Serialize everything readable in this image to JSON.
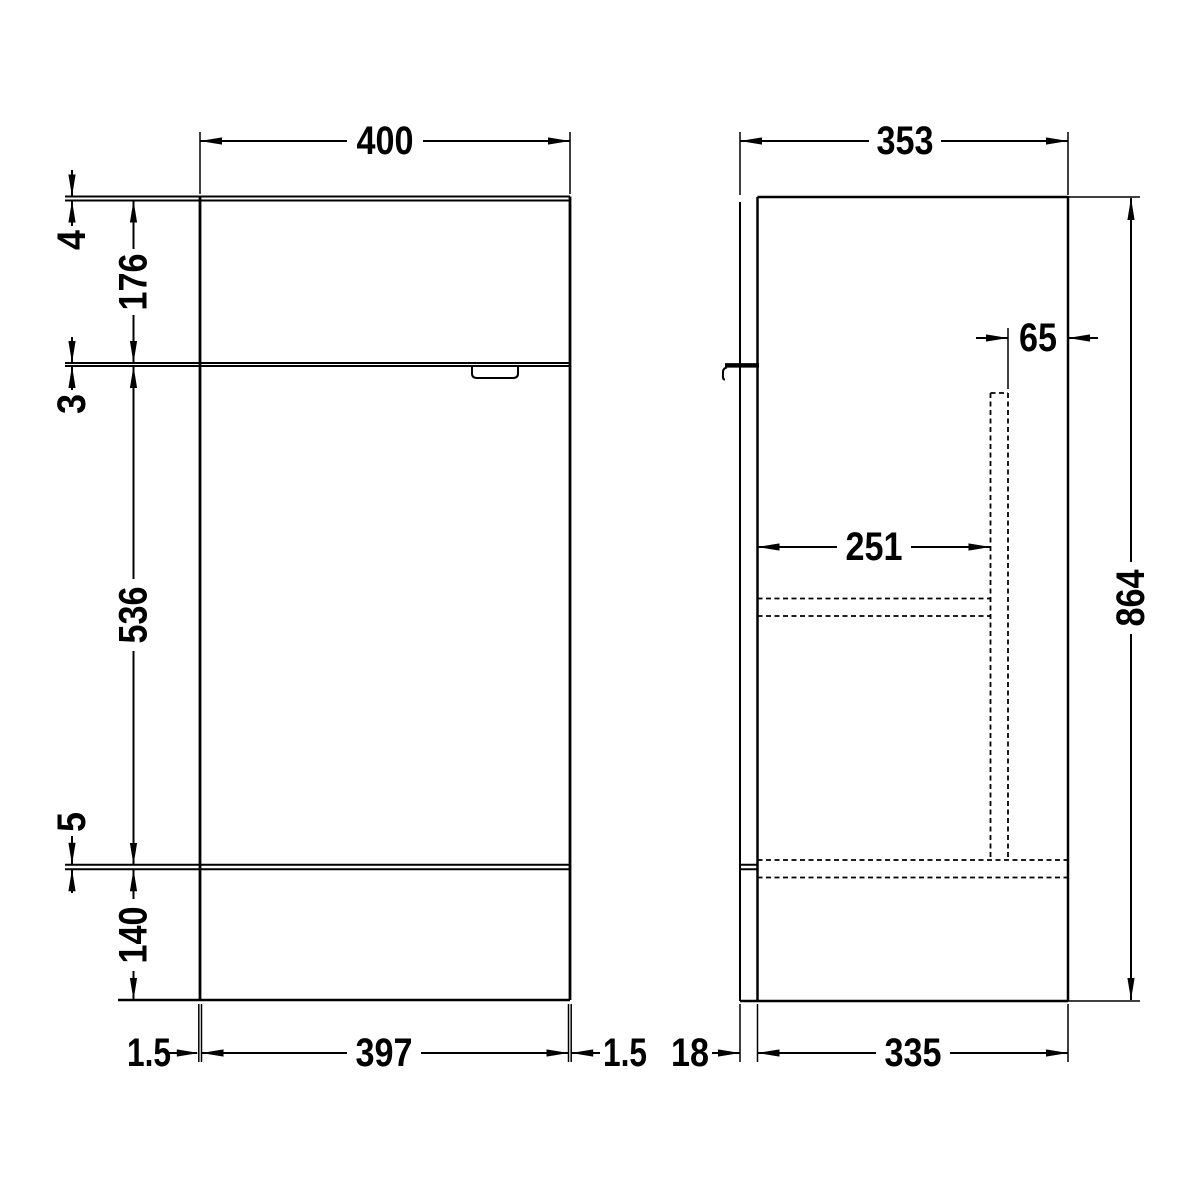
{
  "diagram": {
    "type": "technical-dimension-drawing",
    "subject": "vanity-unit-elevation-and-side-section",
    "colors": {
      "line": "#000000",
      "background": "#ffffff"
    },
    "front": {
      "width": "400",
      "worktop_thickness": "4",
      "top_section_height": "176",
      "top_gap": "3",
      "door_height": "536",
      "bottom_gap": "5",
      "plinth_height": "140",
      "left_inset": "1.5",
      "plinth_width": "397",
      "right_inset": "1.5"
    },
    "side": {
      "depth": "353",
      "rear_void": "65",
      "internal_depth": "251",
      "height": "864",
      "front_panel_thickness": "18",
      "carcass_depth": "335"
    }
  }
}
